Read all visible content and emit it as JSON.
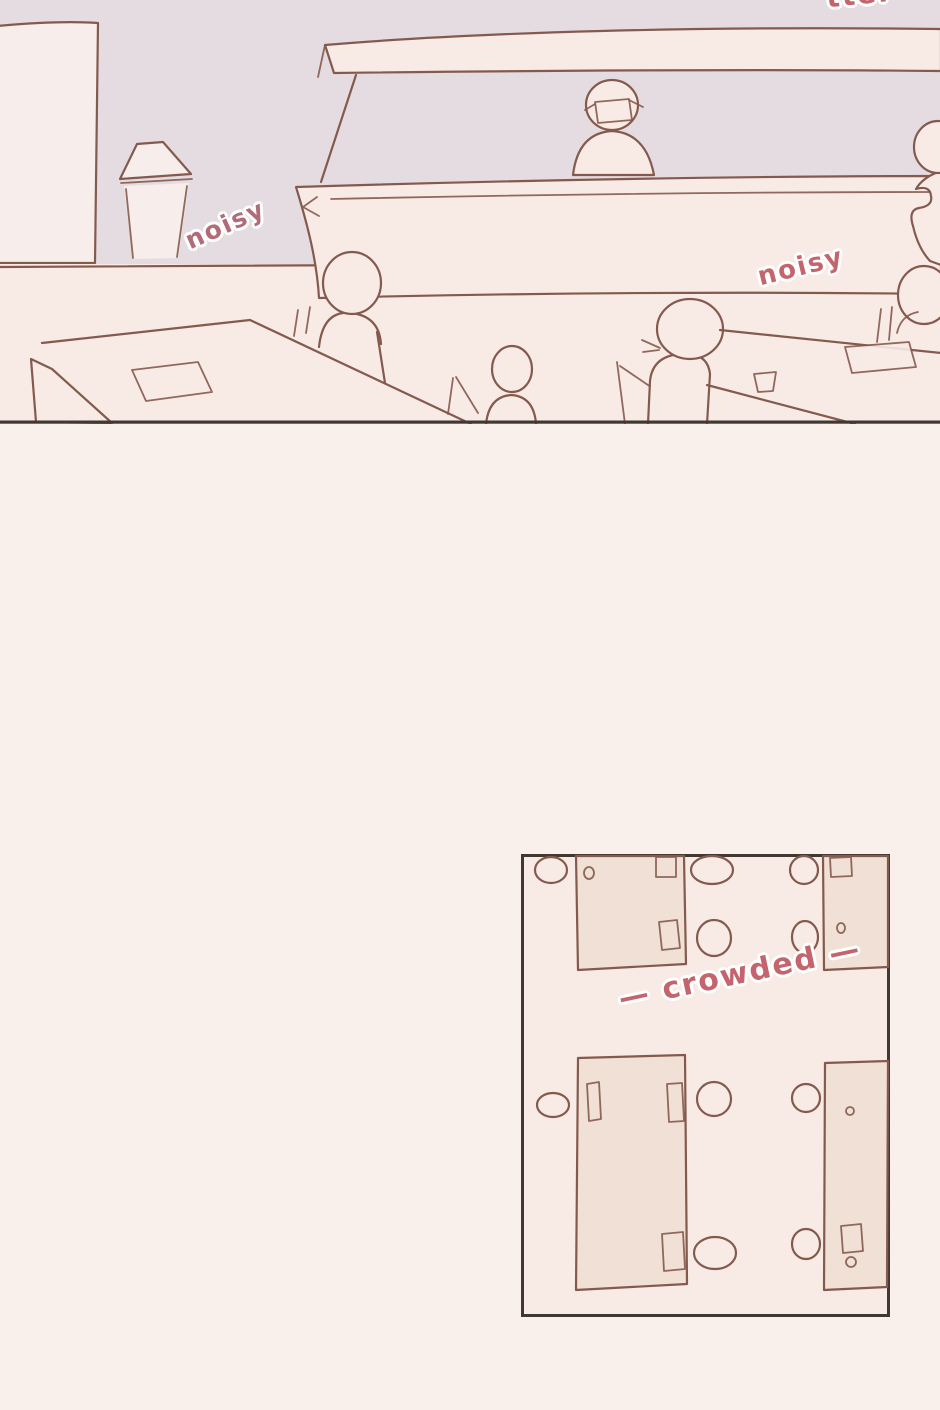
{
  "page": {
    "width_px": 940,
    "height_px": 1410
  },
  "panel_cafe": {
    "labels": {
      "top_edge_fragment": "tter",
      "noisy_left": "noisy",
      "noisy_right": "noisy"
    }
  },
  "panel_floorplan": {
    "labels": {
      "crowded": "— crowded —"
    }
  },
  "colors": {
    "bg": "#faf0eb",
    "wall": "#e5dce2",
    "floor": "#f8ebe5",
    "whiteboard": "#f7edea",
    "table_tan": "#f0e0d5",
    "stroke": "#855a4e",
    "dark_line": "#413834",
    "pink": "#c4656d",
    "pink_muted": "#b26c77",
    "outline_white": "#ffffff"
  }
}
